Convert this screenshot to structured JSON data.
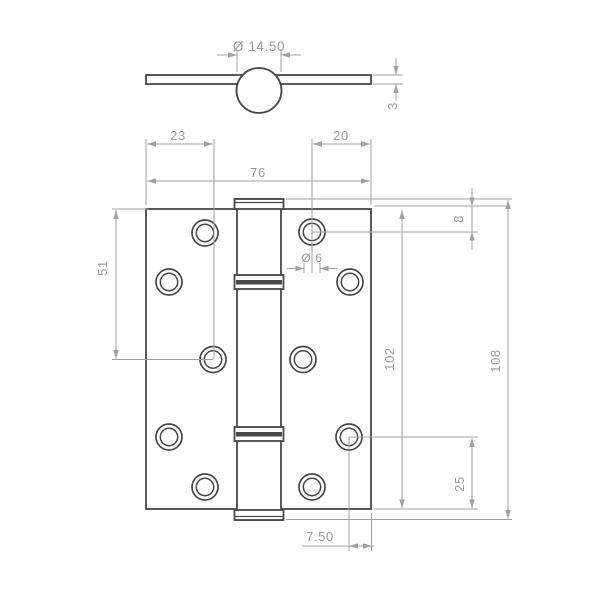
{
  "drawing": {
    "type": "hinge-technical-drawing",
    "colors": {
      "outline": "#474747",
      "dimension_lines": "#a1a1a1",
      "dimension_text": "#9a9a9a",
      "background": "#ffffff"
    },
    "dimensions": {
      "knuckle_diameter": "Ø 14.50",
      "leaf_thickness": "3",
      "left_hole_inset": "23",
      "right_hole_inset": "20",
      "leaf_width": "76",
      "left_hole_span": "51",
      "top_hole_inset": "8",
      "screw_hole_diameter": "Ø 6",
      "leaf_height": "102",
      "overall_height": "108",
      "bottom_hole_inset": "25",
      "corner_hole_inset": "7.50"
    }
  }
}
